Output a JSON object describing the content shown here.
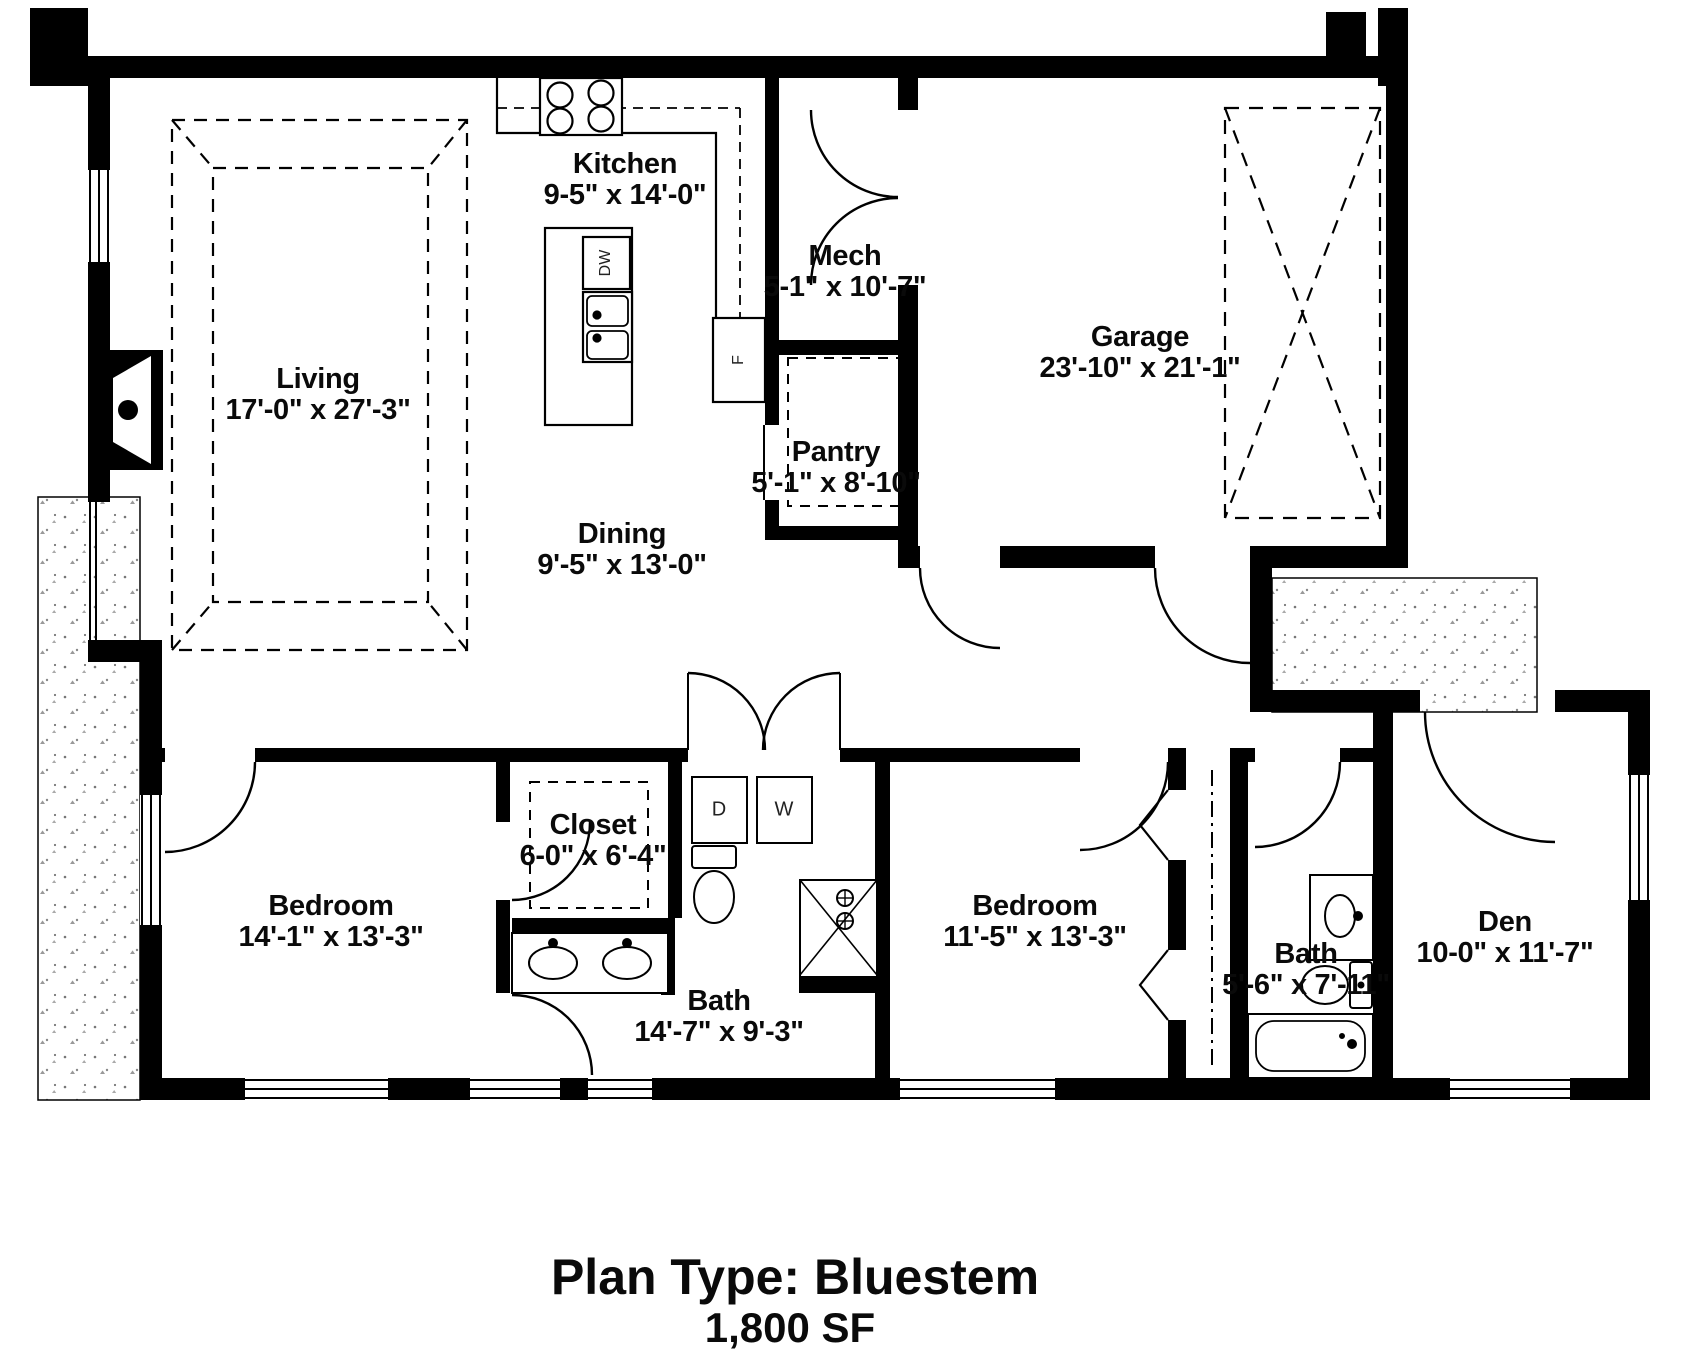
{
  "plan": {
    "title": "Plan Type: Bluestem",
    "area": "1,800 SF"
  },
  "rooms": {
    "living": {
      "name": "Living",
      "dims": "17'-0\" x 27'-3\""
    },
    "kitchen": {
      "name": "Kitchen",
      "dims": "9-5\" x 14'-0\""
    },
    "mech": {
      "name": "Mech",
      "dims": "5-1\" x 10'-7\""
    },
    "pantry": {
      "name": "Pantry",
      "dims": "5'-1\" x 8'-10\""
    },
    "dining": {
      "name": "Dining",
      "dims": "9'-5\" x 13'-0\""
    },
    "garage": {
      "name": "Garage",
      "dims": "23'-10\" x 21'-1\""
    },
    "closet": {
      "name": "Closet",
      "dims": "6-0\" x 6'-4\""
    },
    "bedroom1": {
      "name": "Bedroom",
      "dims": "14'-1\" x 13'-3\""
    },
    "bath1": {
      "name": "Bath",
      "dims": "14'-7\" x 9'-3\""
    },
    "bedroom2": {
      "name": "Bedroom",
      "dims": "11'-5\" x 13'-3\""
    },
    "bath2": {
      "name": "Bath",
      "dims": "5'-6\" x 7'-11\""
    },
    "den": {
      "name": "Den",
      "dims": "10-0\" x 11'-7\""
    }
  },
  "appliances": {
    "dishwasher": "DW",
    "fridge": "F",
    "dryer": "D",
    "washer": "W"
  },
  "colors": {
    "wall": "#000000",
    "background": "#ffffff",
    "label": "#0a0a0a",
    "stipple": "#888888"
  }
}
